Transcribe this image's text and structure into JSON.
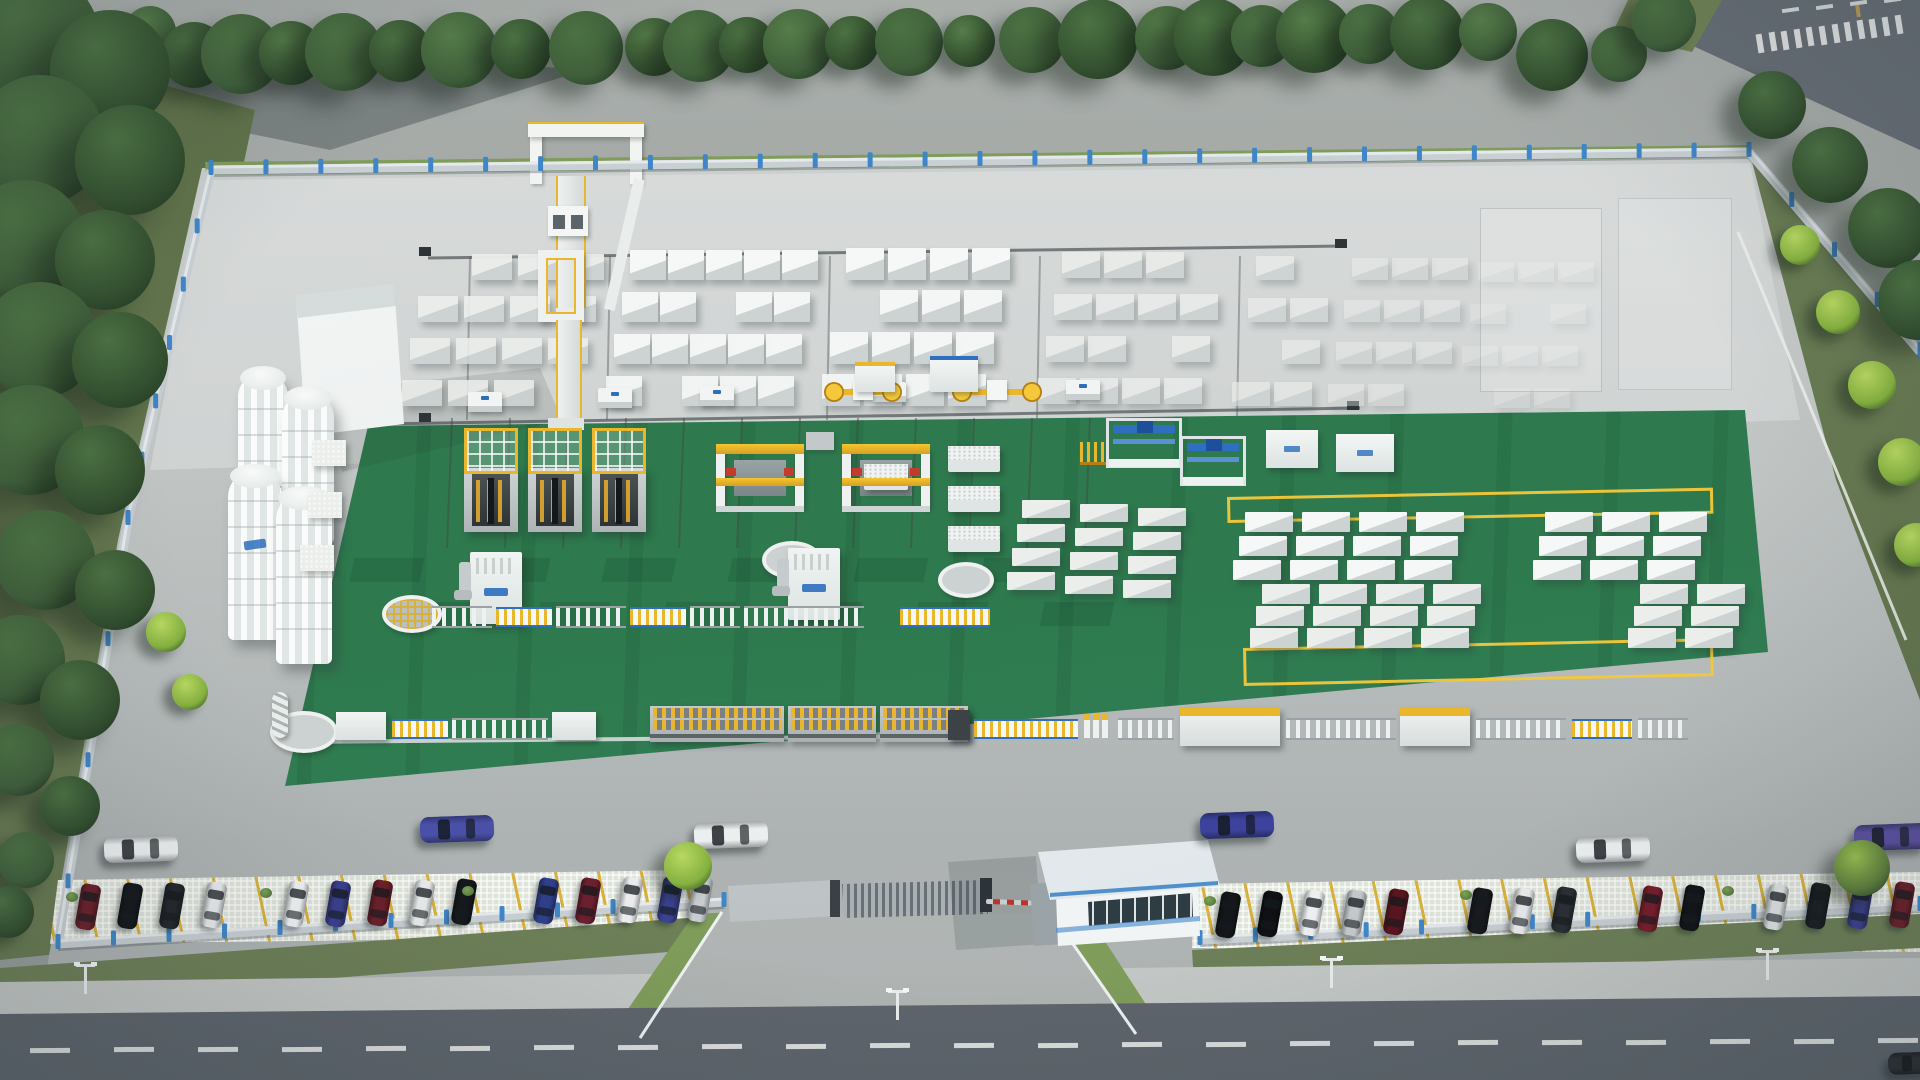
{
  "scene": {
    "description": "Aerial 3D rendering of an AAC block factory compound: white silos, block storage yard with gantry crane, green production-hall floor with cutting and handling machinery, perimeter fence with blue posts, gatehouse with boom barrier, parking rows and surrounding roads with trees",
    "palette": {
      "pavement": "#c7cbca",
      "pavement_deep": "#adb2b2",
      "apron": "#b6bab9",
      "green": "#2e7a4e",
      "green_dark": "#266842",
      "yellow": "#eab62c",
      "yellow_bright": "#f4c83a",
      "white_struct": "#eff2f1",
      "struct_shadow": "#c8cecd",
      "fence_wall": "#c9d0d4",
      "fence_post": "#3f86c9",
      "grass": "#6d7f57",
      "grass_bright": "#7f9c5a",
      "grass_dark": "#5d7048",
      "tree_dark": "#33502f",
      "tree_mid": "#3f5f3a",
      "tree_bright": "#84b13f",
      "road": "#5d646b",
      "road_top": "#666d75",
      "sidewalk": "#c3c7c5",
      "marking": "#e8ebe9",
      "stall_yellow": "#d8b13c",
      "barrier_red": "#d8342a",
      "barrier_white": "#e8ecec",
      "roof": "#dde4e8",
      "roof_trim": "#3f86c9",
      "logo_blue": "#2b6fbe",
      "cake_white": "#f1f3f2",
      "dark_hood": "#3c4246"
    },
    "objects": {
      "silos": {
        "count": 4,
        "color": "#f2f4f3"
      },
      "batching_building": {
        "color": "#f4f6f5"
      },
      "gantry_crane": {
        "count": 1,
        "trim": "#e2ae2a"
      },
      "block_yard_groups": {
        "count": 7
      },
      "cutting_machines": {
        "count": 3
      },
      "tilting_machines": {
        "count": 2
      },
      "dust_collectors": {
        "count": 2
      },
      "blue_gantry_units": {
        "count": 2
      },
      "white_tables": {
        "count": 2
      },
      "transfer_cars": {
        "count": 5
      },
      "clamp_machines": {
        "count": 2
      },
      "circle_pits": {
        "count": 4
      },
      "yellow_marking_rects": {
        "count": 2
      },
      "gate": {
        "type": "retractable",
        "barrier": [
          "#e8ecec",
          "#d8342a"
        ]
      },
      "street_lamps": {
        "count": 4
      }
    },
    "vehicles": {
      "parking_left_car_colors": [
        "#6b1f2a",
        "#14171b",
        "#23262b",
        "#e8eaec",
        "#f0f2f3",
        "#3a3f8c",
        "#6b1f2a",
        "#e8eaec",
        "#15181c",
        "#2f3f8a",
        "#6b2030",
        "#e9ebec",
        "#3b4290",
        "#c8cdd0"
      ],
      "parking_right_car_colors": [
        "#141619",
        "#0f1114",
        "#eceeef",
        "#c3c8cb",
        "#5a1620",
        "#17191d",
        "#e9ebed",
        "#2b2f34",
        "#781d2b",
        "#101318",
        "#dfe3e4",
        "#1b1e23",
        "#3a3f8b",
        "#6b1f2a"
      ],
      "moving_car_colors": [
        "#eceff0",
        "#4a50a8",
        "#eceff0",
        "#3d439c",
        "#eceff0",
        "#5a50a0",
        "#2a2e33"
      ]
    }
  }
}
